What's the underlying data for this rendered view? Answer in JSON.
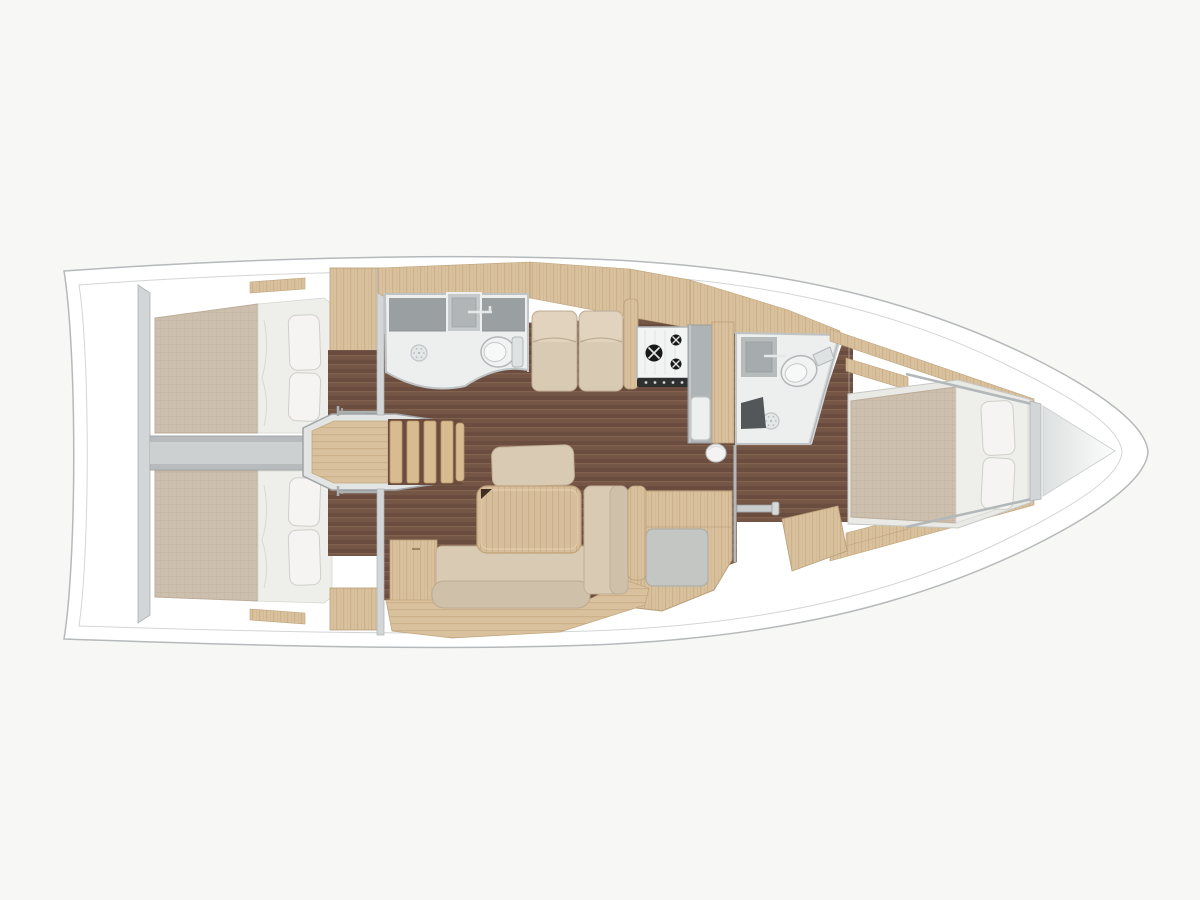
{
  "scene": {
    "name": "sailing-yacht-interior-floor-plan-top-view",
    "areas": [
      "aft-cabin-starboard",
      "aft-cabin-port",
      "engine-compartment",
      "companionway-steps",
      "aft-head-shower",
      "saloon-sofa-table",
      "galley-stove-sink",
      "forward-head-shower",
      "nav-seat",
      "forward-cabin-double-berth",
      "anchor-locker"
    ]
  },
  "colors": {
    "background": "#f7f7f5",
    "hull_fill": "#ffffff",
    "hull_line": "#b6b9bb",
    "inner_line": "#cdd0d1",
    "bulkhead_gray": "#d3d6d7",
    "bulkhead_edge": "#adb1b3",
    "engine_gray": "#b7bbbd",
    "engine_inner": "#ccd0d1",
    "floor_base": "#755646",
    "floor_dark": "#6b4d3f",
    "floor_line": "#8a6954",
    "wood_base": "#d9c19e",
    "wood_grain": "#c9ad85",
    "table_wood": "#d6bd9c",
    "table_grain": "#c6a97f",
    "step_gap": "#6b4c3d",
    "step_wood": "#d8bc90",
    "platform_gray": "#e3e5e5",
    "mattress": "#cdbfae",
    "mattress_weave": "#bfb09c",
    "sheet_white": "#eeeeea",
    "pillow": "#f5f4f2",
    "pillow_edge": "#cfcfca",
    "cushion": "#d9cab4",
    "cushion_flap": "#e1d3bd",
    "cushion_roll": "#cfc0a9",
    "counter_dark": "#9aa0a2",
    "counter_mid": "#aeb3b5",
    "room_floor": "#edefef",
    "fixture_white": "#f1f2f2",
    "seat_gray": "#c4c6c3",
    "stove_white": "#f2f3f3",
    "burner_black": "#191919",
    "knob_strip": "#2e2f2f",
    "shower_seat_dark": "#53575a",
    "locker_from": "#dde0e0",
    "locker_to": "#fdfdfd",
    "cylinder_white": "#f2f3f2",
    "bracket_gray": "#c9cdce"
  }
}
